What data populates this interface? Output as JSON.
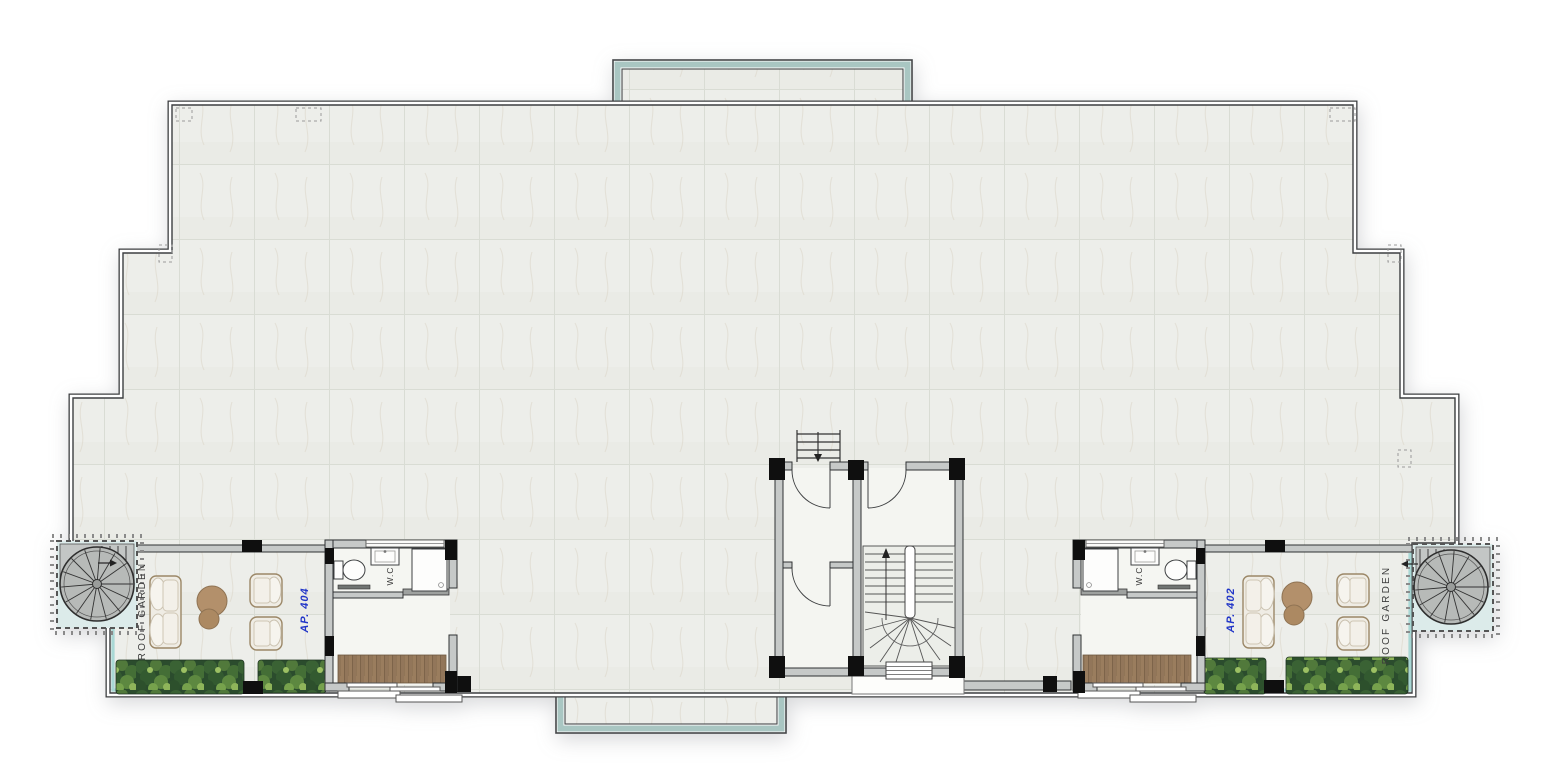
{
  "floor_plan": {
    "labels": {
      "garden_left": "ROOF GARDEN",
      "garden_right": "ROOF GARDEN",
      "apartment_left": "AP. 404",
      "apartment_right": "AP. 402",
      "wc_left": "W.C",
      "wc_right": "W.C"
    },
    "colors": {
      "tile": "#edeeea",
      "tile_line": "#d9dcd4",
      "wall_line": "#3d3f41",
      "wall_fill": "#c6c9c8",
      "column": "#0f0f0f",
      "glass_teal": "#a9c6c2",
      "railing_teal": "#a5d6d4",
      "label_blue": "#2236c8",
      "label_dark": "#3c3c3c",
      "wood": "#9a7d5e",
      "plant_green": "#3a6234",
      "furniture_cream": "#efece4",
      "furniture_trim": "#9b8767",
      "table_wood": "#b3906b",
      "stair_gray": "#b7bab8"
    }
  }
}
